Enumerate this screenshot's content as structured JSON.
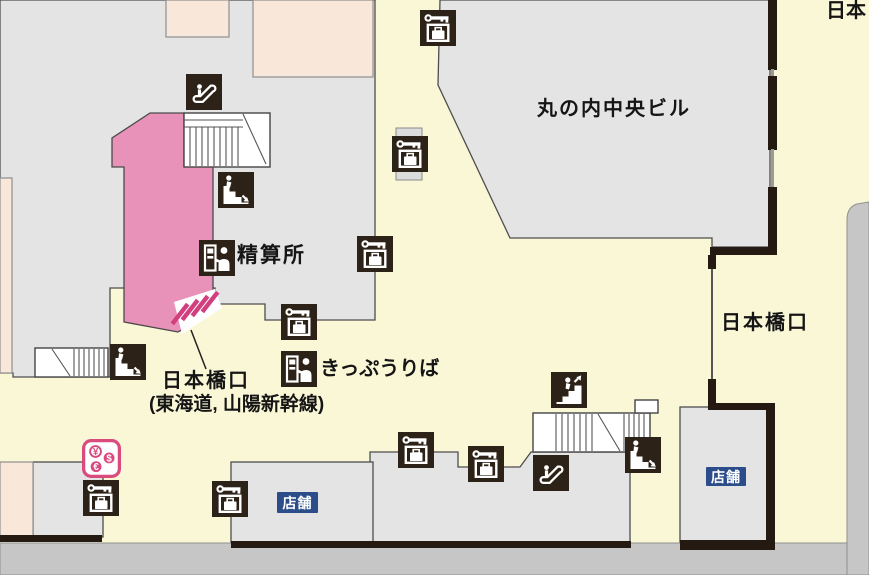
{
  "map": {
    "title": "station-floor-map",
    "labels": [
      {
        "id": "district-top-right",
        "text": "日本",
        "x": 826,
        "y": 1,
        "size": 20,
        "weight": 600,
        "ls": 0
      },
      {
        "id": "marunouchi-building",
        "text": "丸の内中央ビル",
        "x": 537,
        "y": 99,
        "size": 20,
        "weight": 600,
        "ls": 2
      },
      {
        "id": "nihonbashi-exit",
        "text": "日本橋口",
        "x": 721,
        "y": 313,
        "size": 20,
        "weight": 600,
        "ls": 2
      },
      {
        "id": "fare-adjustment-office",
        "text": "精算所",
        "x": 237,
        "y": 245,
        "size": 21,
        "weight": 700,
        "ls": 2
      },
      {
        "id": "ticket-office",
        "text": "きっぷうりば",
        "x": 320,
        "y": 359,
        "size": 20,
        "weight": 700,
        "ls": 0
      },
      {
        "id": "gate-name-line1",
        "text": "日本橋口",
        "x": 162,
        "y": 371,
        "size": 20,
        "weight": 600,
        "ls": 2
      },
      {
        "id": "gate-name-line2",
        "text": "(東海道, 山陽新幹線)",
        "x": 149,
        "y": 395,
        "size": 19,
        "weight": 600,
        "ls": 0
      }
    ],
    "badges": [
      {
        "id": "shop-badge-left",
        "text": "店舗",
        "x": 277,
        "y": 492,
        "w": 41,
        "h": 21
      },
      {
        "id": "shop-badge-right",
        "text": "店舗",
        "x": 706,
        "y": 467,
        "w": 40,
        "h": 19
      }
    ],
    "icons": [
      {
        "sym": "escalator",
        "name": "escalator",
        "x": 186,
        "y": 74
      },
      {
        "sym": "stairs-down",
        "name": "stairs-down",
        "x": 218,
        "y": 172
      },
      {
        "sym": "agent-machine",
        "name": "fare-adjustment-machine",
        "x": 199,
        "y": 240
      },
      {
        "sym": "locker",
        "name": "coin-locker",
        "x": 420,
        "y": 10
      },
      {
        "sym": "locker",
        "name": "coin-locker",
        "x": 392,
        "y": 136
      },
      {
        "sym": "locker",
        "name": "coin-locker",
        "x": 357,
        "y": 236
      },
      {
        "sym": "locker",
        "name": "coin-locker",
        "x": 281,
        "y": 304
      },
      {
        "sym": "agent-machine",
        "name": "ticket-vending-machine",
        "x": 281,
        "y": 351
      },
      {
        "sym": "currency",
        "name": "currency-exchange",
        "x": 82,
        "y": 439,
        "w": 39
      },
      {
        "sym": "locker",
        "name": "coin-locker",
        "x": 83,
        "y": 480
      },
      {
        "sym": "locker",
        "name": "coin-locker",
        "x": 212,
        "y": 481
      },
      {
        "sym": "locker",
        "name": "coin-locker",
        "x": 398,
        "y": 432
      },
      {
        "sym": "locker",
        "name": "coin-locker",
        "x": 468,
        "y": 446
      },
      {
        "sym": "escalator",
        "name": "escalator",
        "x": 533,
        "y": 455
      },
      {
        "sym": "stairs-up",
        "name": "stairs-up",
        "x": 551,
        "y": 372
      },
      {
        "sym": "stairs-down",
        "name": "stairs-down",
        "x": 625,
        "y": 437
      },
      {
        "sym": "stairs-down",
        "name": "stairs-down",
        "x": 110,
        "y": 344
      }
    ],
    "colors": {
      "walkway": "#faf7d7",
      "building": "#e4e4e4",
      "annex": "#f9e7da",
      "gate_area": "#e891b9",
      "gate_bars": "#d23f7e",
      "icon_bg": "#2d2217",
      "road": "#c6c6c6",
      "badge": "#2b4d8a",
      "currency": "#d94b7f",
      "wall": "#241a12"
    }
  }
}
